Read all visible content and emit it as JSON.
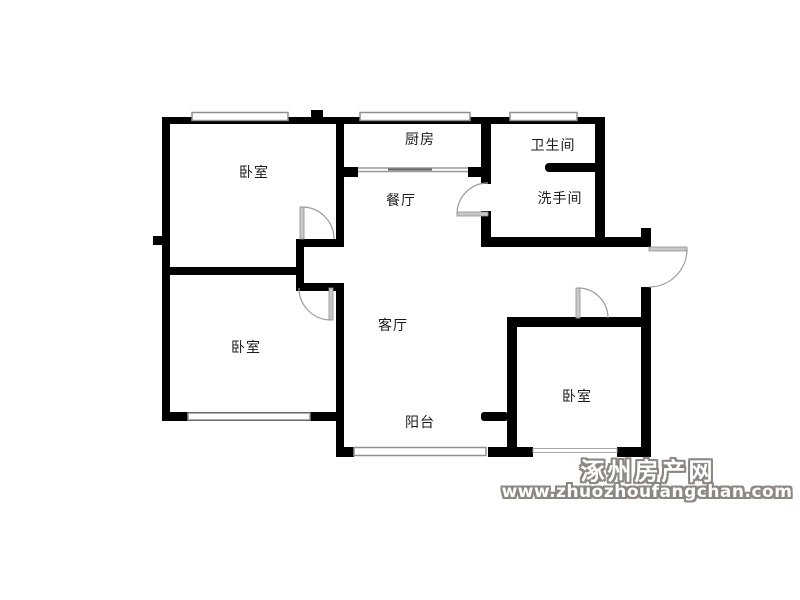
{
  "rooms": [
    {
      "id": "bedroom-top-left",
      "label": "卧室"
    },
    {
      "id": "kitchen",
      "label": "厨房"
    },
    {
      "id": "bathroom",
      "label": "卫生间"
    },
    {
      "id": "washroom",
      "label": "洗手间"
    },
    {
      "id": "dining-room",
      "label": "餐厅"
    },
    {
      "id": "living-room",
      "label": "客厅"
    },
    {
      "id": "bedroom-bottom-left",
      "label": "卧室"
    },
    {
      "id": "bedroom-bottom-right",
      "label": "卧室"
    },
    {
      "id": "balcony",
      "label": "阳台"
    }
  ],
  "watermark": {
    "site_name": "涿州房产网",
    "site_url": "www.zhuozhoufangchan.com"
  },
  "colors": {
    "wall": "#000000",
    "window_frame": "#909090",
    "door_panel": "#c8c8c8",
    "door_arc": "#9a9a9a",
    "label_text": "#1c1c1c",
    "watermark_outline": "#8d8781",
    "watermark_fill": "#ffffff",
    "background": "#ffffff"
  }
}
